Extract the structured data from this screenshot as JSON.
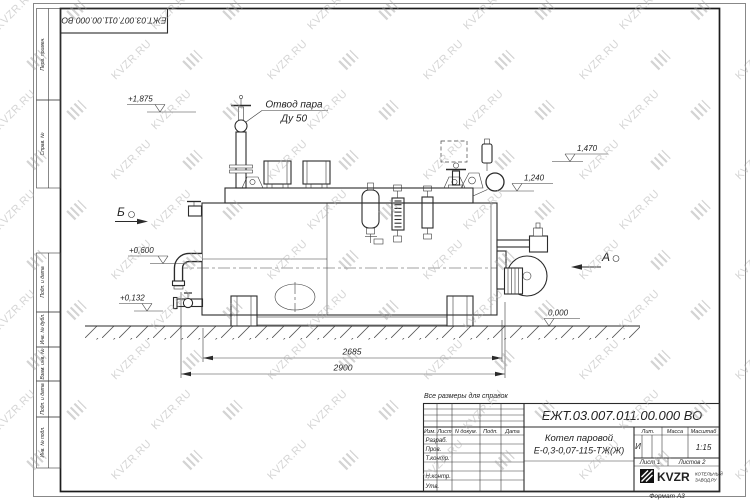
{
  "watermark": {
    "text": "KVZR.RU"
  },
  "side_stamp": {
    "items": [
      "Перв. примен.",
      "Справ. №",
      "Подп. и дата",
      "Инв. № дубл.",
      "Взам. инв. №",
      "Подп. и дата",
      "Инв. № подл."
    ]
  },
  "doc": {
    "number": "ЕЖТ.03.007.011.00.000  ВО",
    "format": "Формат А3",
    "note": "Все размеры для справок"
  },
  "title_block": {
    "name_line1": "Котел паровой",
    "name_line2": "Е-0,3-0,07-115-ТЖ(Ж)",
    "lit_header": "Лит.",
    "mass_header": "Масса",
    "scale_header": "Масштаб",
    "lit_value": "И",
    "scale_value": "1:15",
    "sheet_info": "Лист 1",
    "sheets_info": "Листов 2",
    "columns": {
      "izm": "Изм.",
      "list": "Лист",
      "ndoc": "N докум.",
      "podp": "Подп.",
      "data": "Дата"
    },
    "rows": {
      "razrab": "Разраб.",
      "prov": "Пров.",
      "tkontr": "Т.контр.",
      "nkontr": "Н.контр.",
      "utv": "Утв."
    },
    "logo": {
      "name": "KVZR",
      "sub1": "КОТЕЛЬНЫЙ",
      "sub2": "ЗАВОД.РУ"
    }
  },
  "annotations": {
    "steam_line1": "Отвод пара",
    "steam_line2": "Ду 50",
    "elev_top": "+1,875",
    "elev_mid": "+0,600",
    "elev_low": "+0,132",
    "elev_r1": "1,470",
    "elev_r2": "1,240",
    "elev_zero": "0,000",
    "view_b": "Б",
    "view_a": "А",
    "dim_inner": "2685",
    "dim_outer": "2900"
  }
}
